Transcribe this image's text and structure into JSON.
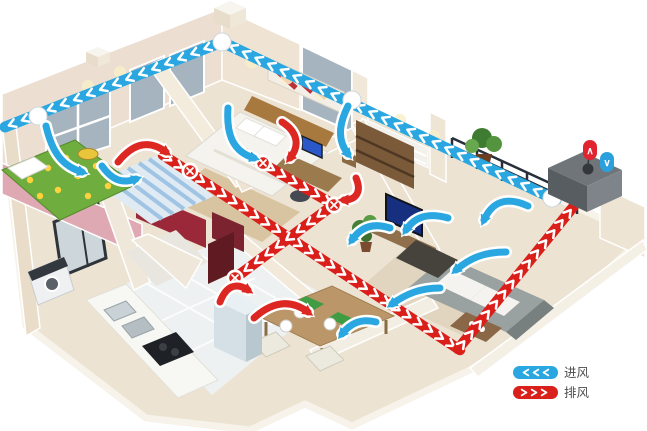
{
  "legend": {
    "items": [
      {
        "id": "intake",
        "label": "进风",
        "icon": "chevrons-left-pill",
        "color": "#2aa7e0"
      },
      {
        "id": "exhaust",
        "label": "排风",
        "icon": "chevrons-right-pill",
        "color": "#d9201a"
      }
    ]
  },
  "unit": {
    "exhaust_marker": "∧",
    "intake_marker": "∨",
    "exhaust_color": "#e02430",
    "intake_color": "#2ba0dd"
  },
  "colors": {
    "intake_duct": "#2aa7e0",
    "exhaust_duct": "#da1f1a",
    "background": "#ffffff",
    "wall": "#efe7d8",
    "accent_pink": "#dfa9b4",
    "accent_maroon": "#7b232f"
  }
}
